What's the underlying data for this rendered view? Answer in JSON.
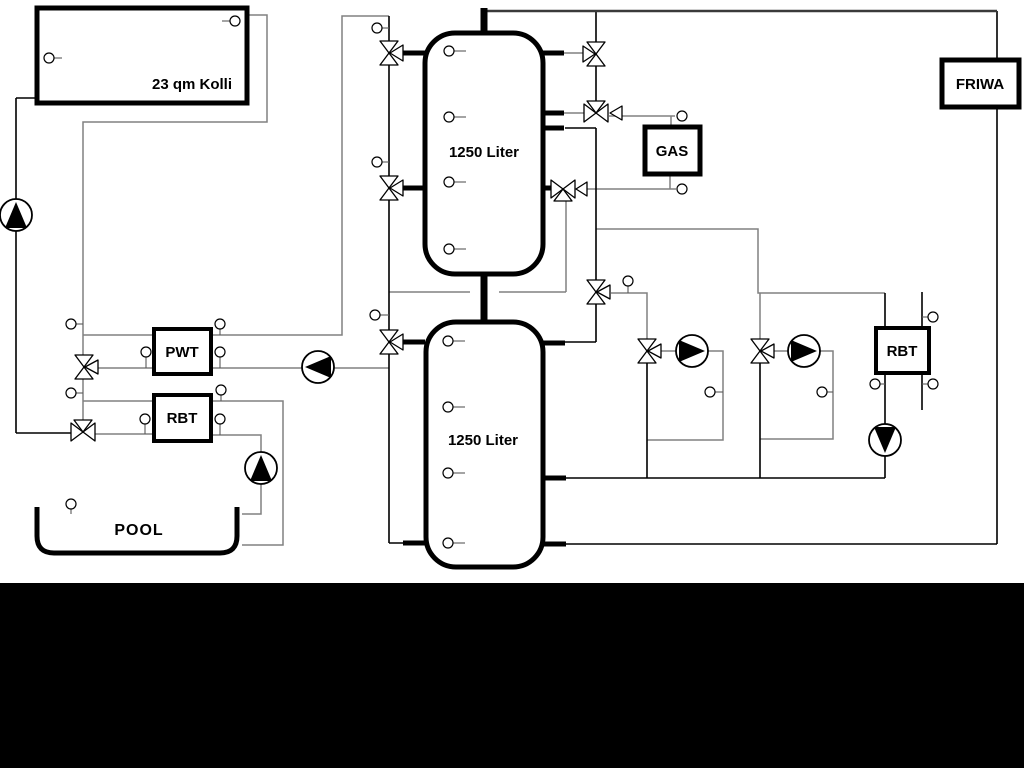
{
  "diagram": {
    "type": "hydraulic-heating-scheme",
    "labels": {
      "collector": "23 qm Kolli",
      "tank_top": "1250 Liter",
      "tank_bottom": "1250 Liter",
      "pwt": "PWT",
      "rbt_left": "RBT",
      "rbt_right": "RBT",
      "gas": "GAS",
      "friwa": "FRIWA",
      "pool": "POOL"
    },
    "colors": {
      "background": "#ffffff",
      "pipe_gray": "#808080",
      "pipe_black": "#000000",
      "footer_bar": "#000000"
    }
  }
}
